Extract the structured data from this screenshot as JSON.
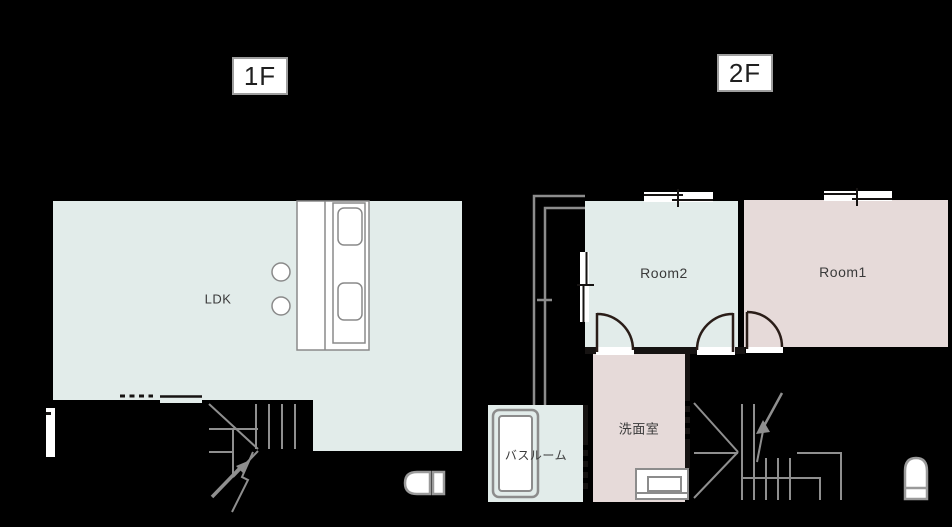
{
  "colors": {
    "background": "#000000",
    "room_blue": "#e2ecea",
    "room_pink": "#e6dad9",
    "line_gray": "#8c8c8c",
    "fixture_gray": "#9a9a9a",
    "wall_dark": "#161312",
    "door_dark": "#2a1d18",
    "box_border": "#9e9e9e",
    "label_text": "#1f1f1f",
    "room_text": "#3a3a3a"
  },
  "floor1": {
    "label": "1F",
    "rooms": {
      "ldk": "LDK"
    },
    "fixtures": [
      "kitchen-counter",
      "sink",
      "cooktop",
      "stool",
      "sliding-door",
      "dashed-opening",
      "entrance-door",
      "staircase-up-arrow",
      "toilet"
    ]
  },
  "floor2": {
    "label": "2F",
    "rooms": {
      "room1": "Room1",
      "room2": "Room2",
      "washroom": "洗面室",
      "bathroom": "バスルーム"
    },
    "fixtures": [
      "balcony",
      "sliding-window",
      "hinged-door",
      "bathtub",
      "washbasin",
      "staircase-up-arrow",
      "toilet"
    ]
  }
}
